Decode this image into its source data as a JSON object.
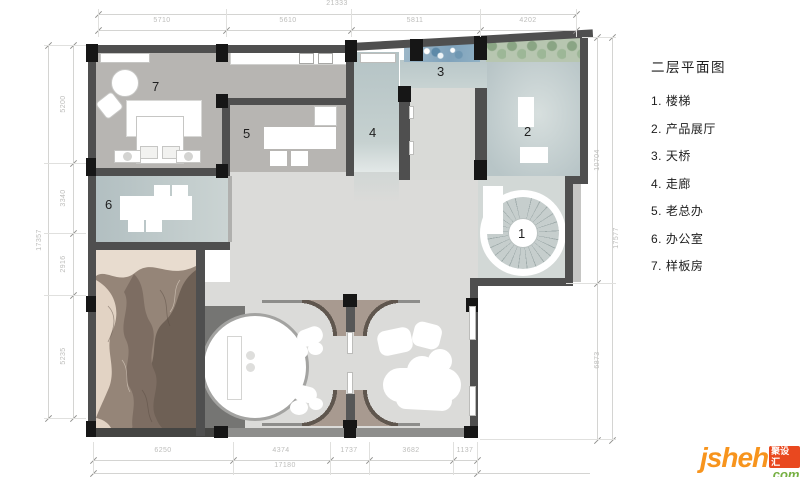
{
  "legend": {
    "title": "二层平面图",
    "items": [
      "1. 楼梯",
      "2. 产品展厅",
      "3. 天桥",
      "4. 走廊",
      "5. 老总办",
      "6. 办公室",
      "7. 样板房"
    ]
  },
  "plan_markers": [
    "1",
    "2",
    "3",
    "4",
    "5",
    "6",
    "7"
  ],
  "dimensions": {
    "top": {
      "overall": "21333",
      "segments": [
        "5710",
        "5610",
        "5811",
        "4202"
      ]
    },
    "left": {
      "overall": "17357",
      "segments": [
        "5200",
        "3340",
        "2916",
        "5235"
      ]
    },
    "right": {
      "overall": "17577",
      "segments": [
        "10704",
        "6873"
      ]
    },
    "bottom": {
      "overall": "17180",
      "segments": [
        "6250",
        "4374",
        "1737",
        "3682",
        "1137"
      ]
    }
  },
  "logo": {
    "brand": "jsheh",
    "badge": "聚设汇",
    "tld": ".com"
  },
  "colors": {
    "wall": "#4f4f4f",
    "column": "#161616",
    "floor_gray": "#b7b5b2",
    "floor_blue": "#bdc9ca",
    "floor_light": "#dbdbd9",
    "art_brown": "#958578",
    "hedge_green": "#9db797",
    "water_blue": "#85a6bd",
    "brand_orange": "#f7941d",
    "brand_green": "#76b043",
    "badge_red": "#e9481f",
    "dim_text": "#bdbdbb"
  }
}
